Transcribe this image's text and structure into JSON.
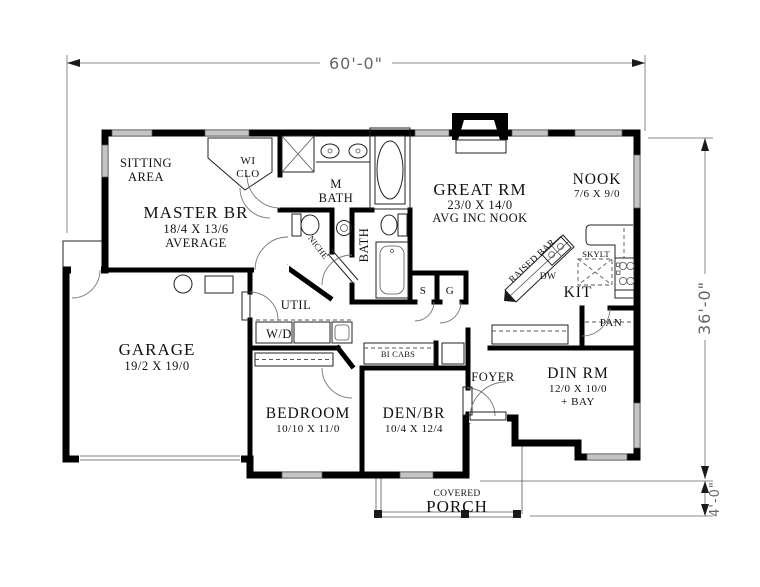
{
  "dimensions": {
    "overall_width": "60'-0\"",
    "overall_depth": "36'-0\"",
    "porch_depth": "4'-0\""
  },
  "rooms": {
    "sitting_area": {
      "line1": "SITTING",
      "line2": "AREA"
    },
    "wi_clo": {
      "line1": "WI",
      "line2": "CLO"
    },
    "master_br": {
      "name": "MASTER BR",
      "size": "18/4 X 13/6",
      "note": "AVERAGE"
    },
    "m_bath": {
      "line1": "M",
      "line2": "BATH"
    },
    "great_rm": {
      "name": "GREAT RM",
      "size": "23/0 X 14/0",
      "note": "AVG INC NOOK"
    },
    "nook": {
      "name": "NOOK",
      "size": "7/6 X 9/0"
    },
    "bath": {
      "name": "BATH"
    },
    "util": {
      "name": "UTIL"
    },
    "garage": {
      "name": "GARAGE",
      "size": "19/2 X 19/0"
    },
    "bedroom": {
      "name": "BEDROOM",
      "size": "10/10 X 11/0"
    },
    "den_br": {
      "name": "DEN/BR",
      "size": "10/4 X 12/4"
    },
    "foyer": {
      "name": "FOYER"
    },
    "din_rm": {
      "name": "DIN RM",
      "size": "12/0 X 10/0",
      "note": "+ BAY"
    },
    "kit": {
      "name": "KIT"
    },
    "pan": {
      "name": "PAN"
    },
    "porch": {
      "line1": "COVERED",
      "line2": "PORCH"
    }
  },
  "features": {
    "niche": "NICHE",
    "raised_bar": "RAISED BAR",
    "dw": "DW",
    "skylt": "SKYLT",
    "wd": "W/D",
    "bi_cabs": "BI CABS",
    "s_closet": "S",
    "g_closet": "G"
  },
  "colors": {
    "wall": "#000000",
    "window": "#c4c4c4",
    "dimension": "#666666",
    "background": "#ffffff"
  }
}
